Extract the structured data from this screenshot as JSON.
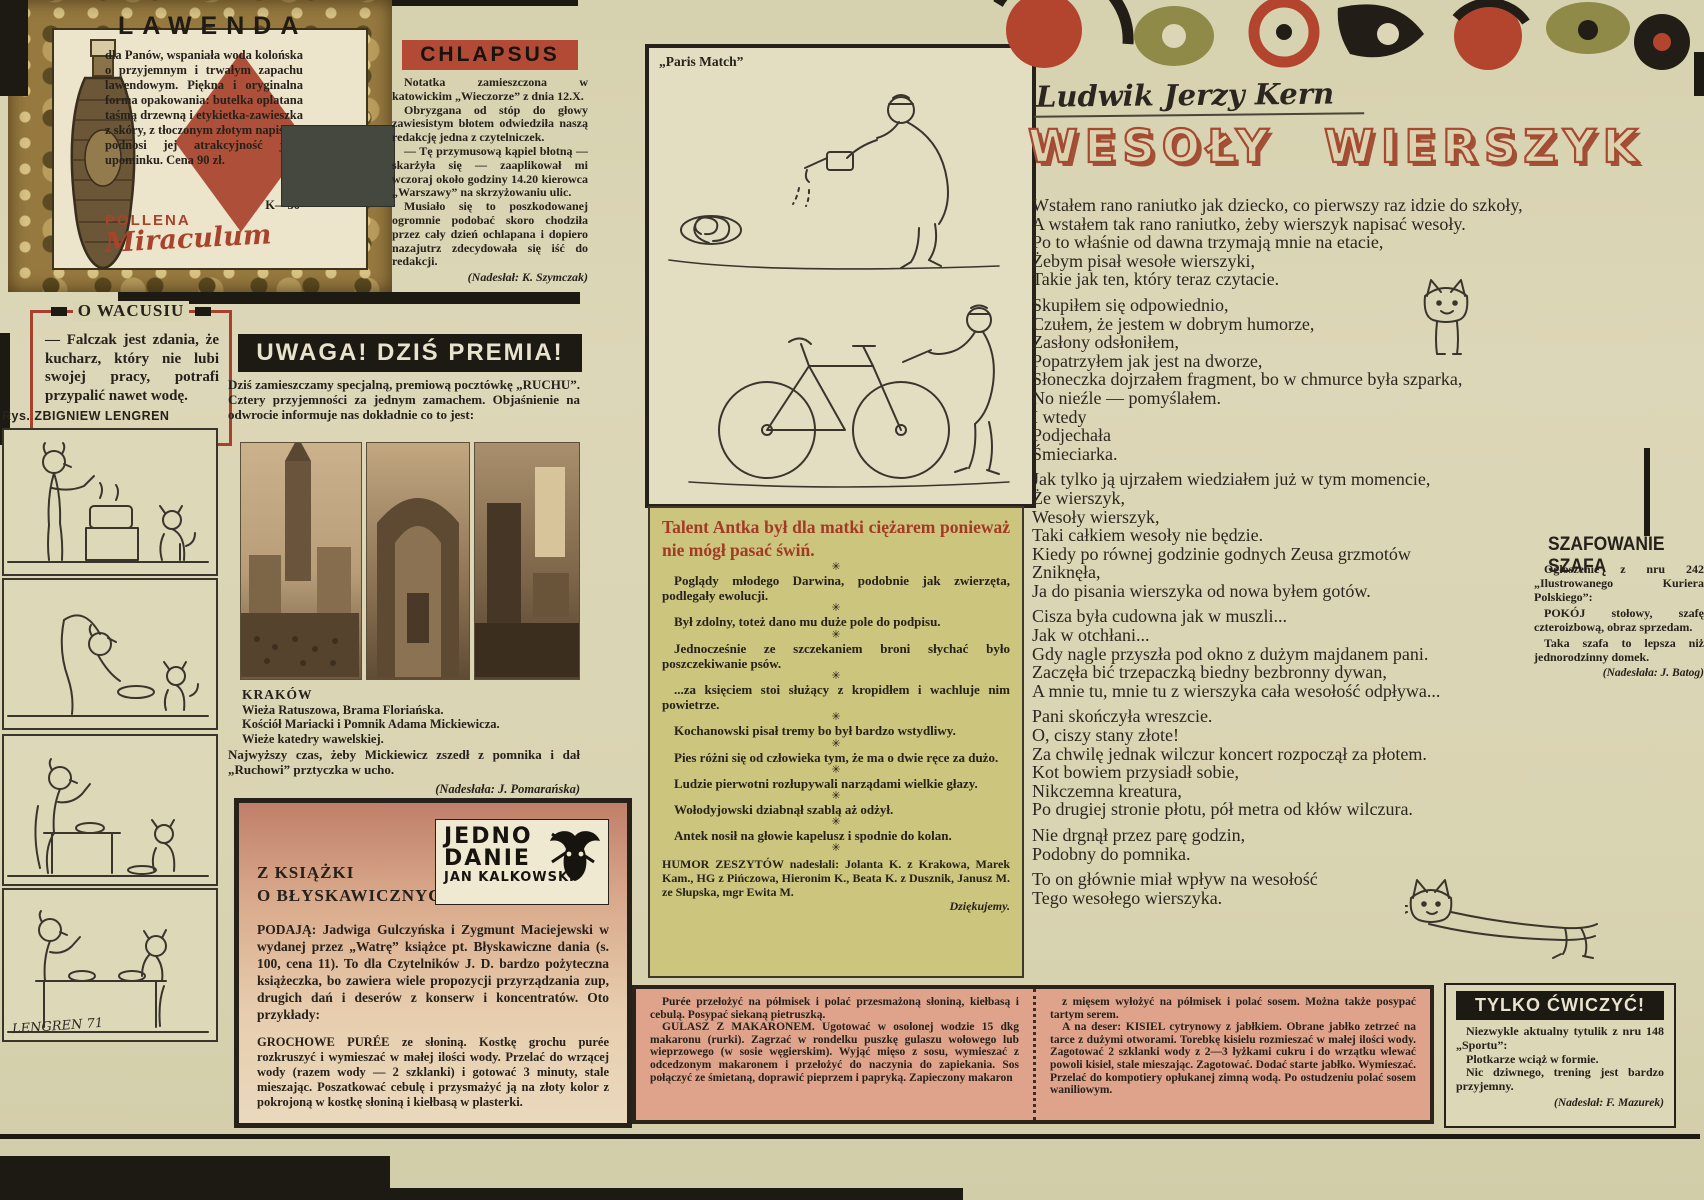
{
  "lawenda": {
    "title": "LAWENDA",
    "body": "dla Panów, wspaniała woda kolońska o przyjemnym i trwałym zapachu lawendowym. Piękna i oryginalna forma opakowania: butelka oplatana taśmą drzewną i etykietka-zawieszka z skóry, z tłoczonym złotym napisem, podnosi jej atrakcyjność jako upominku. Cena 90 zł.",
    "code": "K—30",
    "brand_top": "POLLENA",
    "brand_script": "Miraculum"
  },
  "o_wacusiu": {
    "title": "O WACUSIU",
    "body": "— Falczak jest zdania, że kucharz, który nie lubi swojej pracy, potrafi przypalić nawet wodę."
  },
  "comic": {
    "credit": "Rys. ZBIGNIEW LENGREN",
    "signature": "LENGREN 71"
  },
  "chlapsus": {
    "title": "CHLAPSUS",
    "paragraphs": [
      "Notatka zamieszczona w katowickim „Wieczorze” z dnia 12.X.",
      "Obryzgana od stóp do głowy zawiesistym błotem odwiedziła naszą redakcję jedna z czytelniczek.",
      "— Tę przymusową kąpiel błotną — skarżyła się — zaaplikował mi wczoraj około godziny 14.20 kierowca „Warszawy” na skrzyżowaniu ulic.",
      "Musiało się to poszkodowanej ogromnie podobać skoro chodziła przez cały dzień ochlapana i dopiero nazajutrz zdecydowała się iść do redakcji."
    ],
    "credit": "(Nadesłał: K. Szymczak)"
  },
  "cartoon": {
    "caption": "„Paris Match”"
  },
  "uwaga": {
    "title": "UWAGA! DZIŚ PREMIA!",
    "body": "Dziś zamieszczamy specjalną, premiową pocztówkę „RUCHU”. Cztery przyjemności za jednym zamachem. Objaśnienie na odwrocie informuje nas dokładnie co to jest:",
    "photo_title": "KRAKÓW",
    "photo_lines": [
      "Wieża Ratuszowa, Brama Floriańska.",
      "Kościół Mariacki i Pomnik Adama Mickiewicza.",
      "Wieże katedry wawelskiej."
    ],
    "comment": "Najwyższy czas, żeby Mickiewicz zszedł z pomnika i dał „Ruchowi” prztyczka w ucho.",
    "credit": "(Nadesłała: J. Pomarańska)"
  },
  "ksiazka": {
    "title_line1": "Z KSIĄŻKI",
    "title_line2": "O BŁYSKAWICZNYCH",
    "logo_line1": "JEDNO",
    "logo_line2": "DANIE",
    "logo_line3": "JAN KALKOWSKI",
    "intro": "PODAJĄ: Jadwiga Gulczyńska i Zygmunt Maciejewski w wydanej przez „Watrę” książce pt. Błyskawiczne dania (s. 100, cena 11). To dla Czytelników J. D. bardzo pożyteczna książeczka, bo zawiera wiele propozycji przyrządzania zup, drugich dań i deserów z konserw i koncentratów. Oto przykłady:",
    "recipe": "GROCHOWE PURÉE ze słoniną. Kostkę grochu purée rozkruszyć i wymieszać w małej ilości wody. Przelać do wrzącej wody (razem wody — 2 szklanki) i gotować 3 minuty, stale mieszając. Poszatkować cebulę i przysmażyć ją na złoty kolor z pokrojoną w kostkę słoniną i kiełbasą w plasterki."
  },
  "humor": {
    "title": "Talent Antka był dla matki ciężarem ponieważ nie mógł pasać świń.",
    "sep": "✳",
    "items": [
      "Poglądy młodego Darwina, podobnie jak zwierzęta, podlegały ewolucji.",
      "Był zdolny, toteż dano mu duże pole do podpisu.",
      "Jednocześnie ze szczekaniem broni słychać było poszczekiwanie psów.",
      "...za księciem stoi służący z kropidłem i wachluje nim powietrze.",
      "Kochanowski pisał tremy bo był bardzo wstydliwy.",
      "Pies różni się od człowieka tym, że ma o dwie ręce za dużo.",
      "Ludzie pierwotni rozłupywali narządami wielkie głazy.",
      "Wołodyjowski dziabnął szablą aż odżył.",
      "Antek nosił na głowie kapelusz i spodnie do kolan."
    ],
    "credits": "HUMOR ZESZYTÓW nadesłali: Jolanta K. z Krakowa, Marek Kam., HG z Pińczowa, Hieronim K., Beata K. z Dusznik, Janusz M. ze Słupska, mgr Ewita M.",
    "thanks": "Dziękujemy."
  },
  "recipes": {
    "left": [
      "Purée przełożyć na półmisek i polać przesmażoną słoniną, kiełbasą i cebulą. Posypać siekaną pietruszką.",
      "GULASZ Z MAKARONEM. Ugotować w osolonej wodzie 15 dkg makaronu (rurki). Zagrzać w rondelku puszkę gulaszu wołowego lub wieprzowego (w sosie węgierskim). Wyjąć mięso z sosu, wymieszać z odcedzonym makaronem i przełożyć do naczynia do zapiekania. Sos połączyć ze śmietaną, doprawić pieprzem i papryką. Zapieczony makaron"
    ],
    "right": [
      "z mięsem wyłożyć na półmisek i polać sosem. Można także posypać tartym serem.",
      "A na deser: KISIEL cytrynowy z jabłkiem. Obrane jabłko zetrzeć na tarce z dużymi otworami. Torebkę kisielu rozmieszać w małej ilości wody. Zagotować 2 szklanki wody z 2—3 łyżkami cukru i do wrzątku wlewać powoli kisiel, stale mieszając. Zagotować. Dodać starte jabłko. Wymieszać. Przelać do kompotiery opłukanej zimną wodą. Po ostudzeniu polać sosem waniliowym."
    ]
  },
  "kern": {
    "author": "Ludwik Jerzy Kern",
    "title": "WESOŁY WIERSZYK",
    "stanzas": [
      [
        "Wstałem rano raniutko jak dziecko, co pierwszy raz idzie do szkoły,",
        "A wstałem tak rano raniutko, żeby wierszyk napisać wesoły.",
        "Po to właśnie od dawna trzymają mnie na etacie,",
        "Żebym pisał wesołe wierszyki,",
        "Takie jak ten, który teraz czytacie."
      ],
      [
        "Skupiłem się odpowiednio,",
        "Czułem, że jestem w dobrym humorze,",
        "Zasłony odsłoniłem,",
        "Popatrzyłem jak jest na dworze,",
        "Słoneczka dojrzałem fragment, bo w chmurce była szparka,",
        "No nieźle — pomyślałem.",
        "I wtedy",
        "Podjechała",
        "Śmieciarka."
      ],
      [
        "Jak tylko ją ujrzałem wiedziałem już w tym momencie,",
        "Że wierszyk,",
        "Wesoły wierszyk,",
        "Taki całkiem wesoły nie będzie.",
        "Kiedy po równej godzinie godnych Zeusa grzmotów",
        "Zniknęła,",
        "Ja do pisania wierszyka od nowa byłem gotów."
      ],
      [
        "Cisza była cudowna jak w muszli...",
        "Jak w otchłani...",
        "Gdy nagle przyszła pod okno z dużym majdanem pani.",
        "Zaczęła bić trzepaczką biedny bezbronny dywan,",
        "A mnie tu, mnie tu z wierszyka cała wesołość odpływa..."
      ],
      [
        "Pani skończyła wreszcie.",
        "O, ciszy stany złote!",
        "Za chwilę jednak wilczur koncert rozpoczął za płotem.",
        "Kot bowiem przysiadł sobie,",
        "Nikczemna kreatura,",
        "Po drugiej stronie płotu, pół metra od kłów wilczura."
      ],
      [
        "Nie drgnął przez parę godzin,",
        "Podobny do pomnika."
      ],
      [
        "To on głównie miał wpływ na wesołość",
        "Tego wesołego wierszyka."
      ]
    ]
  },
  "szafowanie": {
    "title": "SZAFOWANIE SZAFĄ",
    "p1": "Ogłoszenie z nru 242 „Ilustrowanego Kuriera Polskiego”:",
    "p2": "POKÓJ stołowy, szafę czteroizbową, obraz sprzedam.",
    "p3": "Taka szafa to lepsza niż jednorodzinny domek.",
    "credit": "(Nadesłała: J. Batog)"
  },
  "tylko": {
    "title": "TYLKO ĆWICZYĆ!",
    "p1": "Niezwykle aktualny tytulik z nru 148 „Sportu”:",
    "p2": "Plotkarze wciąż w formie.",
    "p3": "Nic dziwnego, trening jest bardzo przyjemny.",
    "credit": "(Nadesłał: F. Mazurek)"
  }
}
